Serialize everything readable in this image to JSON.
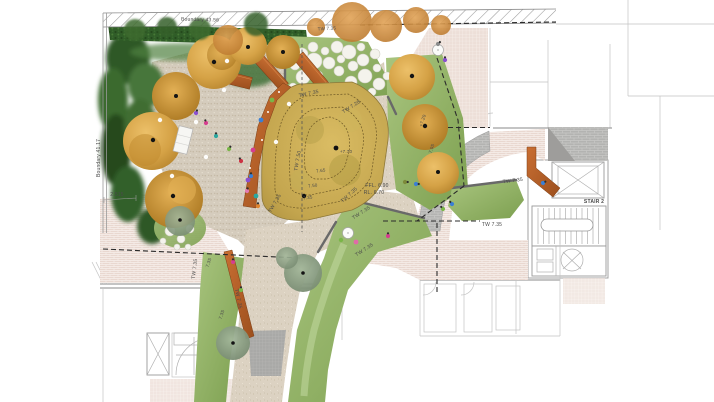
{
  "palette": {
    "paving_pink": "#e9d8d0",
    "paving_fine_grid": "#eddfd8",
    "path_beige": "#dcd2c2",
    "play_mulch": "#d6cdbe",
    "paving_grey": "#b3b3b1",
    "lawn_green": "#8fb368",
    "lawn_light": "#c2d8a0",
    "hedge_green": "#305d28",
    "foliage_dark_green": "#2e5827",
    "tree_gold": "#d8a549",
    "tree_orange": "#cf8a3c",
    "tree_grey_green": "#8ba186",
    "corten_orange": "#b05c28",
    "mound_gold": "#c9ab52",
    "stepping_stone": "#f4f3ec",
    "boundary_line": "#2b2b2b",
    "annotation_text": "#4a4a4a"
  },
  "annotations": [
    {
      "id": "boundary-top",
      "text": "Boundary 43.56",
      "x": 200,
      "y": 21,
      "rot": 1.5,
      "size": 5,
      "color": "#a8a8a8"
    },
    {
      "id": "boundary-left",
      "text": "Boundary 41.17",
      "x": 100,
      "y": 158,
      "rot": -90,
      "size": 5,
      "color": "#a8a8a8"
    },
    {
      "id": "tw-mound-top",
      "text": "TW 7.35",
      "x": 309,
      "y": 95,
      "rot": -12,
      "size": 5
    },
    {
      "id": "tw-728",
      "text": "TW 7.28",
      "x": 352,
      "y": 108,
      "rot": -33,
      "size": 5
    },
    {
      "id": "tw-750",
      "text": "TW 7.50",
      "x": 299,
      "y": 161,
      "rot": -80,
      "size": 5
    },
    {
      "id": "tw-mound-left",
      "text": "TW 7.35",
      "x": 276,
      "y": 204,
      "rot": -60,
      "size": 5
    },
    {
      "id": "tw-mound-bottom",
      "text": "TW 7.35",
      "x": 350,
      "y": 196,
      "rot": -42,
      "size": 5
    },
    {
      "id": "spot-770",
      "text": "+7.70",
      "x": 346,
      "y": 153,
      "rot": 0,
      "size": 4.5
    },
    {
      "id": "contour-765",
      "text": "7.65",
      "x": 321,
      "y": 172,
      "rot": -8,
      "size": 4.5
    },
    {
      "id": "contour-750",
      "text": "7.50",
      "x": 313,
      "y": 187,
      "rot": -8,
      "size": 4.5
    },
    {
      "id": "contour-735",
      "text": "7.35",
      "x": 308,
      "y": 199,
      "rot": -8,
      "size": 4.5
    },
    {
      "id": "ffl",
      "text": "FFL. 6.90",
      "x": 377,
      "y": 187,
      "rot": 0,
      "size": 5
    },
    {
      "id": "rl",
      "text": "RL. 6.70",
      "x": 374,
      "y": 194,
      "rot": 0,
      "size": 5
    },
    {
      "id": "spot-720",
      "text": "+7.20",
      "x": 424,
      "y": 121,
      "rot": -72,
      "size": 4.5
    },
    {
      "id": "spot-705",
      "text": "7.05",
      "x": 433,
      "y": 149,
      "rot": -72,
      "size": 4.5
    },
    {
      "id": "tw-lawn-1",
      "text": "TW 7.35",
      "x": 362,
      "y": 214,
      "rot": -33,
      "size": 5
    },
    {
      "id": "tw-lawn-2",
      "text": "TW 7.35",
      "x": 365,
      "y": 251,
      "rot": -33,
      "size": 5
    },
    {
      "id": "tw-east-lawn",
      "text": "TW 7.35",
      "x": 513,
      "y": 182,
      "rot": -7,
      "size": 5
    },
    {
      "id": "tw-east-boundary",
      "text": "TW 7.35",
      "x": 492,
      "y": 226,
      "rot": 0,
      "size": 5
    },
    {
      "id": "stair-2",
      "text": "STAIR 2",
      "x": 594,
      "y": 203,
      "rot": 0,
      "size": 5,
      "bold": true,
      "color": "#2b2b2b"
    },
    {
      "id": "tw-west-1",
      "text": "TW 7.35",
      "x": 196,
      "y": 269,
      "rot": -83,
      "size": 5
    },
    {
      "id": "spot-735-a",
      "text": "7.35",
      "x": 210,
      "y": 263,
      "rot": -72,
      "size": 4.5
    },
    {
      "id": "spot-735-b",
      "text": "7.35",
      "x": 223,
      "y": 315,
      "rot": -72,
      "size": 4.5
    },
    {
      "id": "tw-corten-wall",
      "text": "TW 7.35",
      "x": 237,
      "y": 299,
      "rot": 78,
      "size": 5
    },
    {
      "id": "dim-2515",
      "text": "2.515",
      "x": 117,
      "y": 196,
      "rot": 0,
      "size": 5,
      "color": "#8a8a8a"
    },
    {
      "id": "tw-hedge",
      "text": "TW 7.35",
      "x": 327,
      "y": 30,
      "rot": -3,
      "size": 4.5,
      "color": "#909090"
    }
  ]
}
